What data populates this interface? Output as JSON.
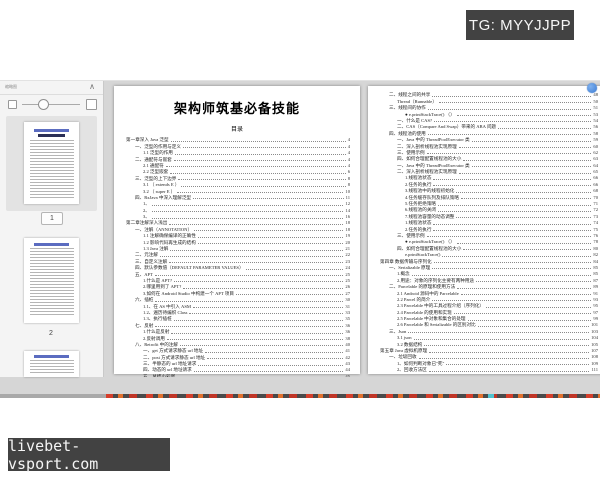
{
  "overlays": {
    "top_tag_label": "TG: MYYJJPP",
    "bottom_tag_label": "livebet-vsport.com"
  },
  "viewer": {
    "sidebar": {
      "panel_title": "缩略图",
      "thumb1_label": "1",
      "thumb2_label": "2"
    },
    "document": {
      "title": "架构师筑基必备技能",
      "toc_heading": "目录",
      "left_page_lines": [
        {
          "t": "第一章深入 Java 泛型",
          "p": "4",
          "v": 0
        },
        {
          "t": "一、泛型的作用与定义",
          "p": "4",
          "v": 1
        },
        {
          "t": "1.1 泛型的作用",
          "p": "4",
          "v": 2
        },
        {
          "t": "二、通配符与嵌套",
          "p": "4",
          "v": 1
        },
        {
          "t": "2.1 通配符",
          "p": "4",
          "v": 2
        },
        {
          "t": "2.2 泛型嵌套",
          "p": "6",
          "v": 2
        },
        {
          "t": "三、泛型的上下边界",
          "p": "8",
          "v": 1
        },
        {
          "t": "3.1 （ extends E ）",
          "p": "8",
          "v": 2
        },
        {
          "t": "3.2 （ super E ）",
          "p": "10",
          "v": 2
        },
        {
          "t": "四、RxJava 中深入理解泛型",
          "p": "11",
          "v": 1
        },
        {
          "t": "1、",
          "p": "12",
          "v": 2
        },
        {
          "t": "2、",
          "p": "14",
          "v": 2
        },
        {
          "t": "3、",
          "p": "16",
          "v": 2
        },
        {
          "t": "第二章注解深入浅出",
          "p": "18",
          "v": 0
        },
        {
          "t": "一、注解（ANNOTATION）",
          "p": "18",
          "v": 1
        },
        {
          "t": "1.1 注解确保编译的正确性",
          "p": "19",
          "v": 2
        },
        {
          "t": "1.2 影响代码再生成的结构",
          "p": "20",
          "v": 2
        },
        {
          "t": "1.3 Java 注解",
          "p": "21",
          "v": 2
        },
        {
          "t": "二、元注解",
          "p": "22",
          "v": 1
        },
        {
          "t": "三、自定义注解",
          "p": "23",
          "v": 1
        },
        {
          "t": "四、默认参数值（DEFAULT PARAMETER VALUES）",
          "p": "24",
          "v": 1
        },
        {
          "t": "五、APT",
          "p": "25",
          "v": 1
        },
        {
          "t": "1.什么是 APT?",
          "p": "25",
          "v": 2
        },
        {
          "t": "2.哪里用到了 APT?",
          "p": "26",
          "v": 2
        },
        {
          "t": "3.如何在 Android Studio 中构建一个 APT 项目",
          "p": "27",
          "v": 2
        },
        {
          "t": "六、插桩",
          "p": "30",
          "v": 1
        },
        {
          "t": "1.1、在 AS 中引入 ASM",
          "p": "31",
          "v": 2
        },
        {
          "t": "1.2、遍历待编织 Class",
          "p": "33",
          "v": 2
        },
        {
          "t": "1.3、执行插桩",
          "p": "35",
          "v": 2
        },
        {
          "t": "七、反射",
          "p": "36",
          "v": 1
        },
        {
          "t": "1.什么是反射",
          "p": "36",
          "v": 2
        },
        {
          "t": "2.反射调用",
          "p": "38",
          "v": 2
        },
        {
          "t": "八、Retrofit 中的注解",
          "p": "40",
          "v": 1
        },
        {
          "t": "一、get 方式请求静态 url 地址",
          "p": "41",
          "v": 2
        },
        {
          "t": "二、post 方式请求静态 url 地址",
          "p": "42",
          "v": 2
        },
        {
          "t": "三、半静态的 url 地址请求",
          "p": "43",
          "v": 2
        },
        {
          "t": "四、动态的 url 地址请求",
          "p": "44",
          "v": 2
        },
        {
          "t": "五、总结小彩蛋",
          "p": "45",
          "v": 2
        },
        {
          "t": "第三章 并发编程",
          "p": "46",
          "v": 0
        },
        {
          "t": "一、基础概念",
          "p": "46",
          "v": 1
        }
      ],
      "right_page_lines": [
        {
          "t": "二、线程之间的共享",
          "p": "48",
          "v": 1
        },
        {
          "t": "Thread（Runnable）",
          "p": "50",
          "v": 2
        },
        {
          "t": "三、线程间的协作",
          "p": "51",
          "v": 1
        },
        {
          "t": "● e.printStackTrace() （）",
          "p": "53",
          "v": 3
        },
        {
          "t": "一、什么是 CAS?",
          "p": "54",
          "v": 2
        },
        {
          "t": "二、CAS（Compare And Swap）带来的 ABA 问题",
          "p": "56",
          "v": 2
        },
        {
          "t": "四、线程池的使用",
          "p": "58",
          "v": 1
        },
        {
          "t": "一、Java 中的 ThreadPoolExecutor 类",
          "p": "59",
          "v": 2
        },
        {
          "t": "二、深入剖析线程池实现原理",
          "p": "60",
          "v": 2
        },
        {
          "t": "三、使用示例",
          "p": "62",
          "v": 2
        },
        {
          "t": "四、如何合理配置线程池的大小",
          "p": "63",
          "v": 2
        },
        {
          "t": "一、Java 中的 ThreadPoolExecutor 类",
          "p": "64",
          "v": 2
        },
        {
          "t": "二、深入剖析线程池实现原理",
          "p": "65",
          "v": 2
        },
        {
          "t": "1.线程池状态",
          "p": "66",
          "v": 3
        },
        {
          "t": "2.任务的执行",
          "p": "66",
          "v": 3
        },
        {
          "t": "3.线程池中的线程初始化",
          "p": "68",
          "v": 3
        },
        {
          "t": "4.任务缓存队列及排队策略",
          "p": "70",
          "v": 3
        },
        {
          "t": "5.任务拒绝策略",
          "p": "71",
          "v": 3
        },
        {
          "t": "6.线程池的关闭",
          "p": "72",
          "v": 3
        },
        {
          "t": "7.线程池容量的动态调整",
          "p": "73",
          "v": 3
        },
        {
          "t": "1.线程池状态",
          "p": "74",
          "v": 3
        },
        {
          "t": "2.任务的执行",
          "p": "75",
          "v": 3
        },
        {
          "t": "三、使用示例",
          "p": "76",
          "v": 2
        },
        {
          "t": "● e.printStackTrace() （）",
          "p": "78",
          "v": 3
        },
        {
          "t": "四、如何合理配置线程池的大小",
          "p": "80",
          "v": 2
        },
        {
          "t": "e.printStackTrace()",
          "p": "82",
          "v": 3
        },
        {
          "t": "第四章 数据传输与序列化",
          "p": "84",
          "v": 0
        },
        {
          "t": "一、Serializable 原理",
          "p": "85",
          "v": 1
        },
        {
          "t": "1.概念",
          "p": "85",
          "v": 2
        },
        {
          "t": "2.用途：对象的序列化主要有两种用途",
          "p": "87",
          "v": 2
        },
        {
          "t": "二、Parcelable 的原理和使用方法",
          "p": "89",
          "v": 1
        },
        {
          "t": "2.1 Android 源码中的 Parcelable",
          "p": "91",
          "v": 2
        },
        {
          "t": "2.2 Parcel 的简介",
          "p": "93",
          "v": 2
        },
        {
          "t": "2.3 Parcelable 中的工具过程介绍（序列化）",
          "p": "95",
          "v": 2
        },
        {
          "t": "2.4 Parcelable 的使用和实现",
          "p": "97",
          "v": 2
        },
        {
          "t": "2.5 Parcelable 中对象和集合的处理",
          "p": "99",
          "v": 2
        },
        {
          "t": "2.6 Parcelable 和 Serializable 的区别对比",
          "p": "101",
          "v": 2
        },
        {
          "t": "三、Json",
          "p": "103",
          "v": 1
        },
        {
          "t": "3.1 json",
          "p": "104",
          "v": 2
        },
        {
          "t": "3.2 数据结构",
          "p": "105",
          "v": 2
        },
        {
          "t": "第五章 Java 虚拟机原理",
          "p": "107",
          "v": 0
        },
        {
          "t": "一、垃圾回收",
          "p": "108",
          "v": 1
        },
        {
          "t": "1、如何判断对象已\"死\"",
          "p": "109",
          "v": 2
        },
        {
          "t": "2、回收方法区",
          "p": "111",
          "v": 2
        }
      ]
    },
    "toolbar": {
      "page_current": "1",
      "page_total": "/262",
      "zoom_value": "67%"
    }
  },
  "icons": {
    "collapse": "∧",
    "first_page": "«",
    "prev_page": "‹",
    "next_page": "›",
    "last_page": "»",
    "lamp": "☀",
    "zoom_out": "−",
    "zoom_in": "+",
    "dropdown": "▾"
  },
  "colors": {
    "annotation_red": "#c9473d",
    "tag_background": "#424242",
    "badge_blue": "#3b7bd4",
    "red_tool": "#d92b1f"
  }
}
